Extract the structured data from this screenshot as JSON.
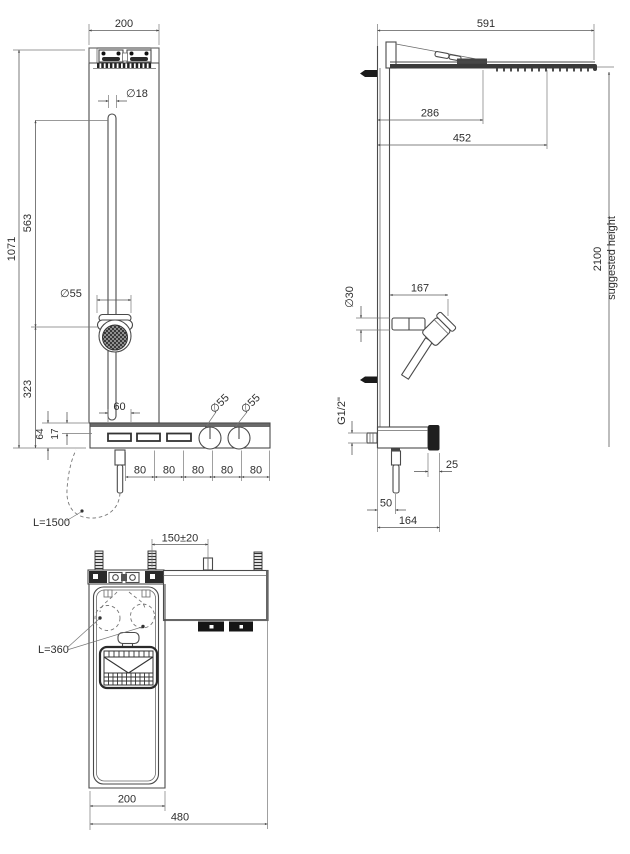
{
  "drawing": {
    "colors": {
      "line": "#4a4a4a",
      "dimension": "#5a5a5a",
      "text": "#2e2e2e",
      "background": "#ffffff"
    },
    "front": {
      "top_width": "200",
      "rail_diameter": "∅18",
      "overall_height": "1071",
      "rail_top_to_handshower": "563",
      "handshower_to_base": "323",
      "handshower_diameter": "∅55",
      "slot_width": "60",
      "shelf_thickness": "64",
      "shelf_inset": "17",
      "left_knob_diameter": "∅55",
      "right_knob_diameter": "∅55",
      "pitch_spacings": [
        "80",
        "80",
        "80",
        "80",
        "80"
      ],
      "hose_length": "L=1500"
    },
    "side": {
      "overall_depth": "591",
      "head_depth_1": "286",
      "head_depth_2": "452",
      "suggested_height": "2100",
      "suggested_height_label": "suggested height",
      "holder_diameter": "∅30",
      "handshower_reach": "167",
      "inlet_thread": "G1/2\"",
      "knob_protrusion": "25",
      "hose_offset": "50",
      "shelf_depth": "164"
    },
    "plan": {
      "fixing_spacing": "150±20",
      "hose_length": "L=360",
      "panel_width": "200",
      "overall_width": "480"
    }
  }
}
